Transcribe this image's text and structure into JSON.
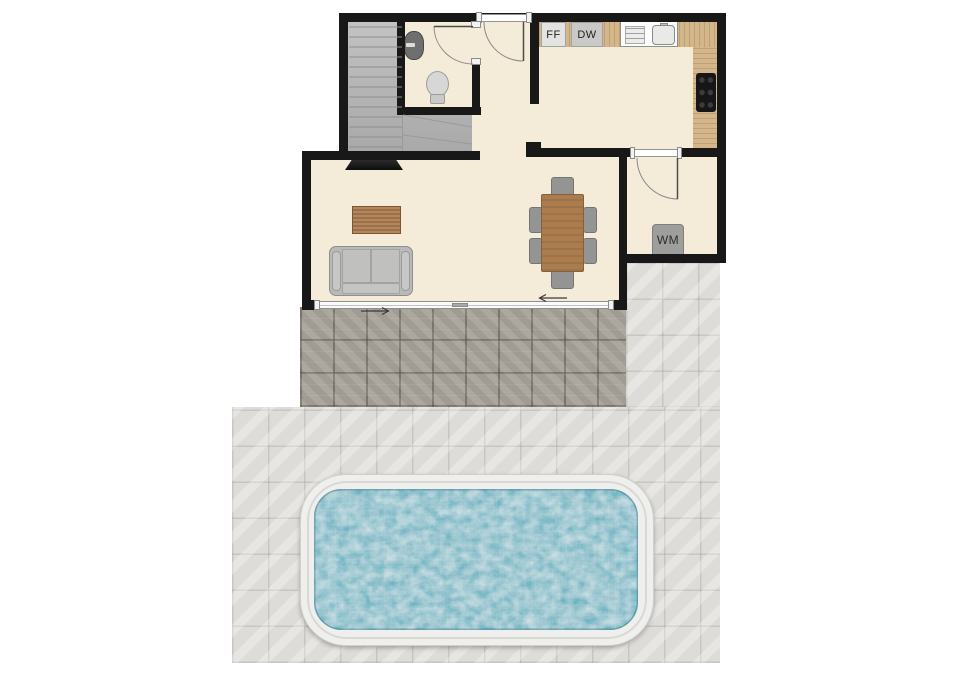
{
  "type": "residential-floor-plan-with-pool",
  "labels": {
    "fridge": "FF",
    "dishwasher": "DW",
    "washing_machine": "WM"
  },
  "colors": {
    "wall": "#181818",
    "floor": "#f4ecd8",
    "stairs": "#b4b4b4",
    "counter_wood": "#d3b68a",
    "furniture_wood": "#ab7c4e",
    "tile_dark": "#a7a39a",
    "tile_light": "#dedcd8",
    "pool_deck": "#efefed",
    "pool_water": "#46a9ba",
    "appliance": "#9e9e9c"
  }
}
